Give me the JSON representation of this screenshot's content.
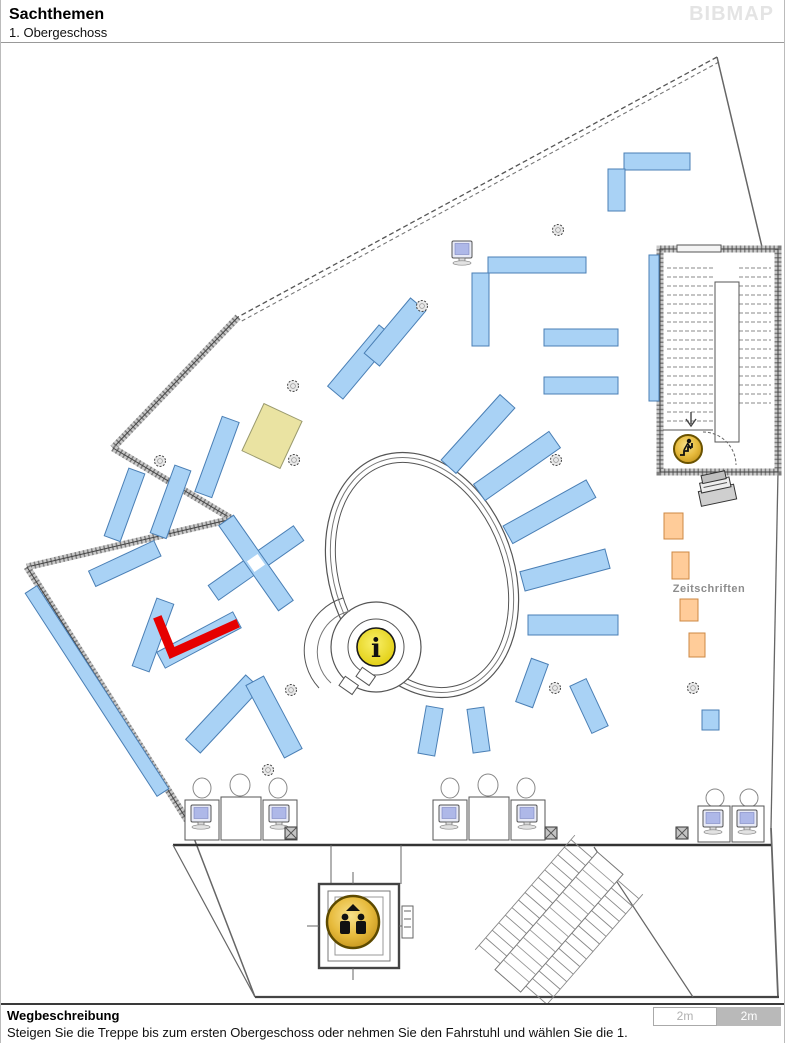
{
  "header": {
    "title": "Sachthemen",
    "subtitle": "1. Obergeschoss",
    "brand": "BIBMAP"
  },
  "map": {
    "labels": {
      "magazines_area": "Zeitschriften"
    },
    "icons": {
      "info_glyph": "i",
      "info_icon": "info-point",
      "elevator_icon": "elevator-persons",
      "stairs_icon": "person-climbing-stairs"
    },
    "legend_colors": {
      "shelf_blue": "#a9d2f5",
      "shelf_stroke": "#4a7fb5",
      "highlight_red": "#e60000",
      "magazine_orange": "#ffcc99",
      "magazine_stroke": "#cc8844",
      "special_yellow": "#eae3a2",
      "icon_gold": "#e7bb3d"
    }
  },
  "footer": {
    "heading": "Wegbeschreibung",
    "description": "Steigen Sie die Treppe bis zum ersten Obergeschoss oder nehmen Sie den Fahrstuhl und wählen Sie die 1.",
    "scale_left": "2m",
    "scale_right": "2m"
  }
}
